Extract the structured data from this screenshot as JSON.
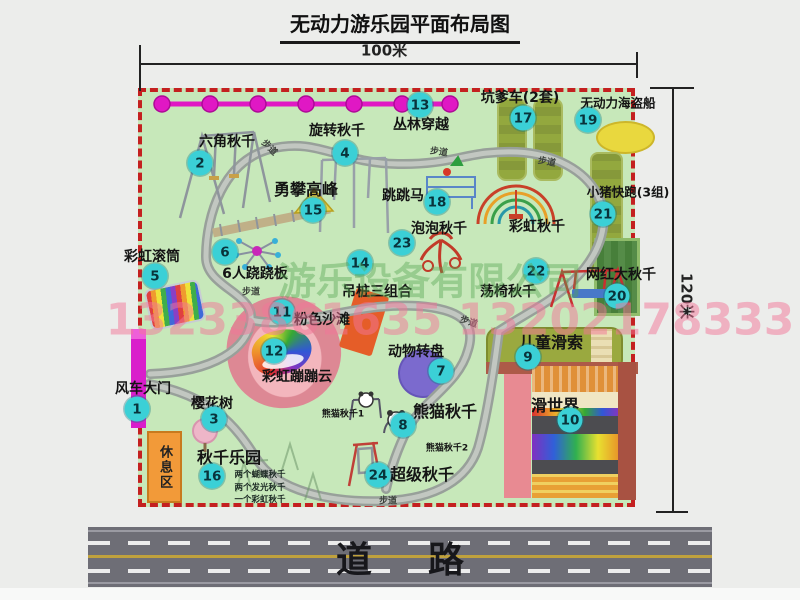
{
  "title": "无动力游乐园平面布局图",
  "dimensions": {
    "width": "100米",
    "height": "120米"
  },
  "road": {
    "label": "道路"
  },
  "watermark": {
    "company": "游乐设备有限公司",
    "phone": "13233861635 13202178333"
  },
  "map": {
    "rest_area": "休息区",
    "walkway_label": "步道",
    "attractions": [
      {
        "num": "1",
        "label": "风车大门"
      },
      {
        "num": "2",
        "label": "六角秋千"
      },
      {
        "num": "3",
        "label": "樱花树"
      },
      {
        "num": "4",
        "label": "旋转秋千"
      },
      {
        "num": "5",
        "label": "彩虹滚筒"
      },
      {
        "num": "6",
        "label": "6人跷跷板"
      },
      {
        "num": "7",
        "label": "动物转盘"
      },
      {
        "num": "8",
        "label": "熊猫秋千"
      },
      {
        "num": "9",
        "label": "儿童滑索"
      },
      {
        "num": "10",
        "label": "滑世界"
      },
      {
        "num": "11",
        "label": "粉色沙滩"
      },
      {
        "num": "12",
        "label": "彩虹蹦蹦云"
      },
      {
        "num": "13",
        "label": "丛林穿越"
      },
      {
        "num": "14",
        "label": "吊桩三组合"
      },
      {
        "num": "15",
        "label": "勇攀高峰"
      },
      {
        "num": "16",
        "label": "秋千乐园"
      },
      {
        "num": "17",
        "label": "坑爹车(2套)"
      },
      {
        "num": "18",
        "label": "跳跳马"
      },
      {
        "num": "19",
        "label": "无动力海盗船"
      },
      {
        "num": "20",
        "label": "网红大秋千"
      },
      {
        "num": "21",
        "label": "小猪快跑(3组)"
      },
      {
        "num": "22",
        "label": "荡椅秋千"
      },
      {
        "num": "23",
        "label": "泡泡秋千"
      },
      {
        "num": "24",
        "label": "超级秋千"
      }
    ],
    "extras": {
      "rainbow_swing": "彩虹秋千",
      "panda_swing_1": "熊猫秋千1",
      "panda_swing_2": "熊猫秋千2",
      "swing_notes": [
        "两个蝴蝶秋千",
        "两个发光秋千",
        "一个彩虹秋千"
      ]
    }
  },
  "colors": {
    "badge": "#3bd0d6",
    "boundary": "#c42020",
    "grass": "#c7e8ba",
    "walkway": "#98a09a",
    "zipline": "#e018c4",
    "road": "#6e6e76"
  }
}
